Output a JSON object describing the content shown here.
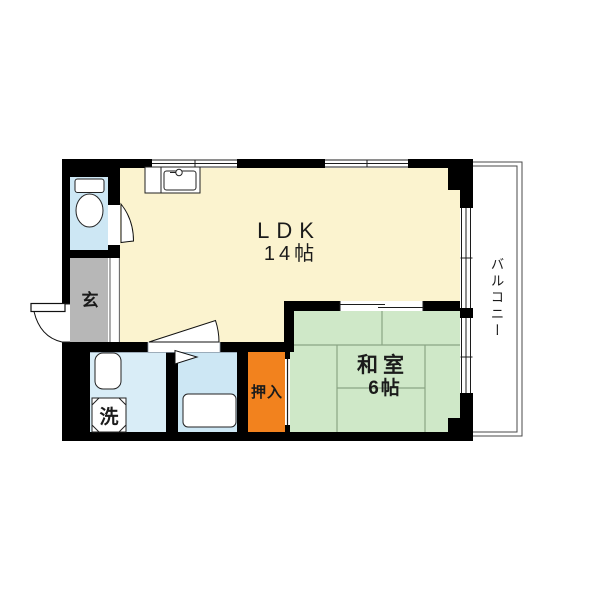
{
  "rooms": {
    "ldk": {
      "name": "LDK",
      "size": "14帖"
    },
    "japanese_room": {
      "name": "和室",
      "size": "6帖"
    },
    "closet": {
      "name": "押入"
    },
    "entrance": {
      "name": "玄"
    },
    "laundry": {
      "name": "洗"
    },
    "balcony": {
      "name": "バルコニー"
    }
  },
  "colors": {
    "wall": "#000000",
    "ldk_floor": "#FBF3CF",
    "tatami": "#CFE8C8",
    "tatami_line": "#8AA584",
    "closet": "#F2821E",
    "entrance": "#B7B7B7",
    "toilet_bath": "#CDE7F4",
    "washroom": "#D9EDF7",
    "balcony_line": "#4A4A4A",
    "text": "#1B1B1B"
  }
}
